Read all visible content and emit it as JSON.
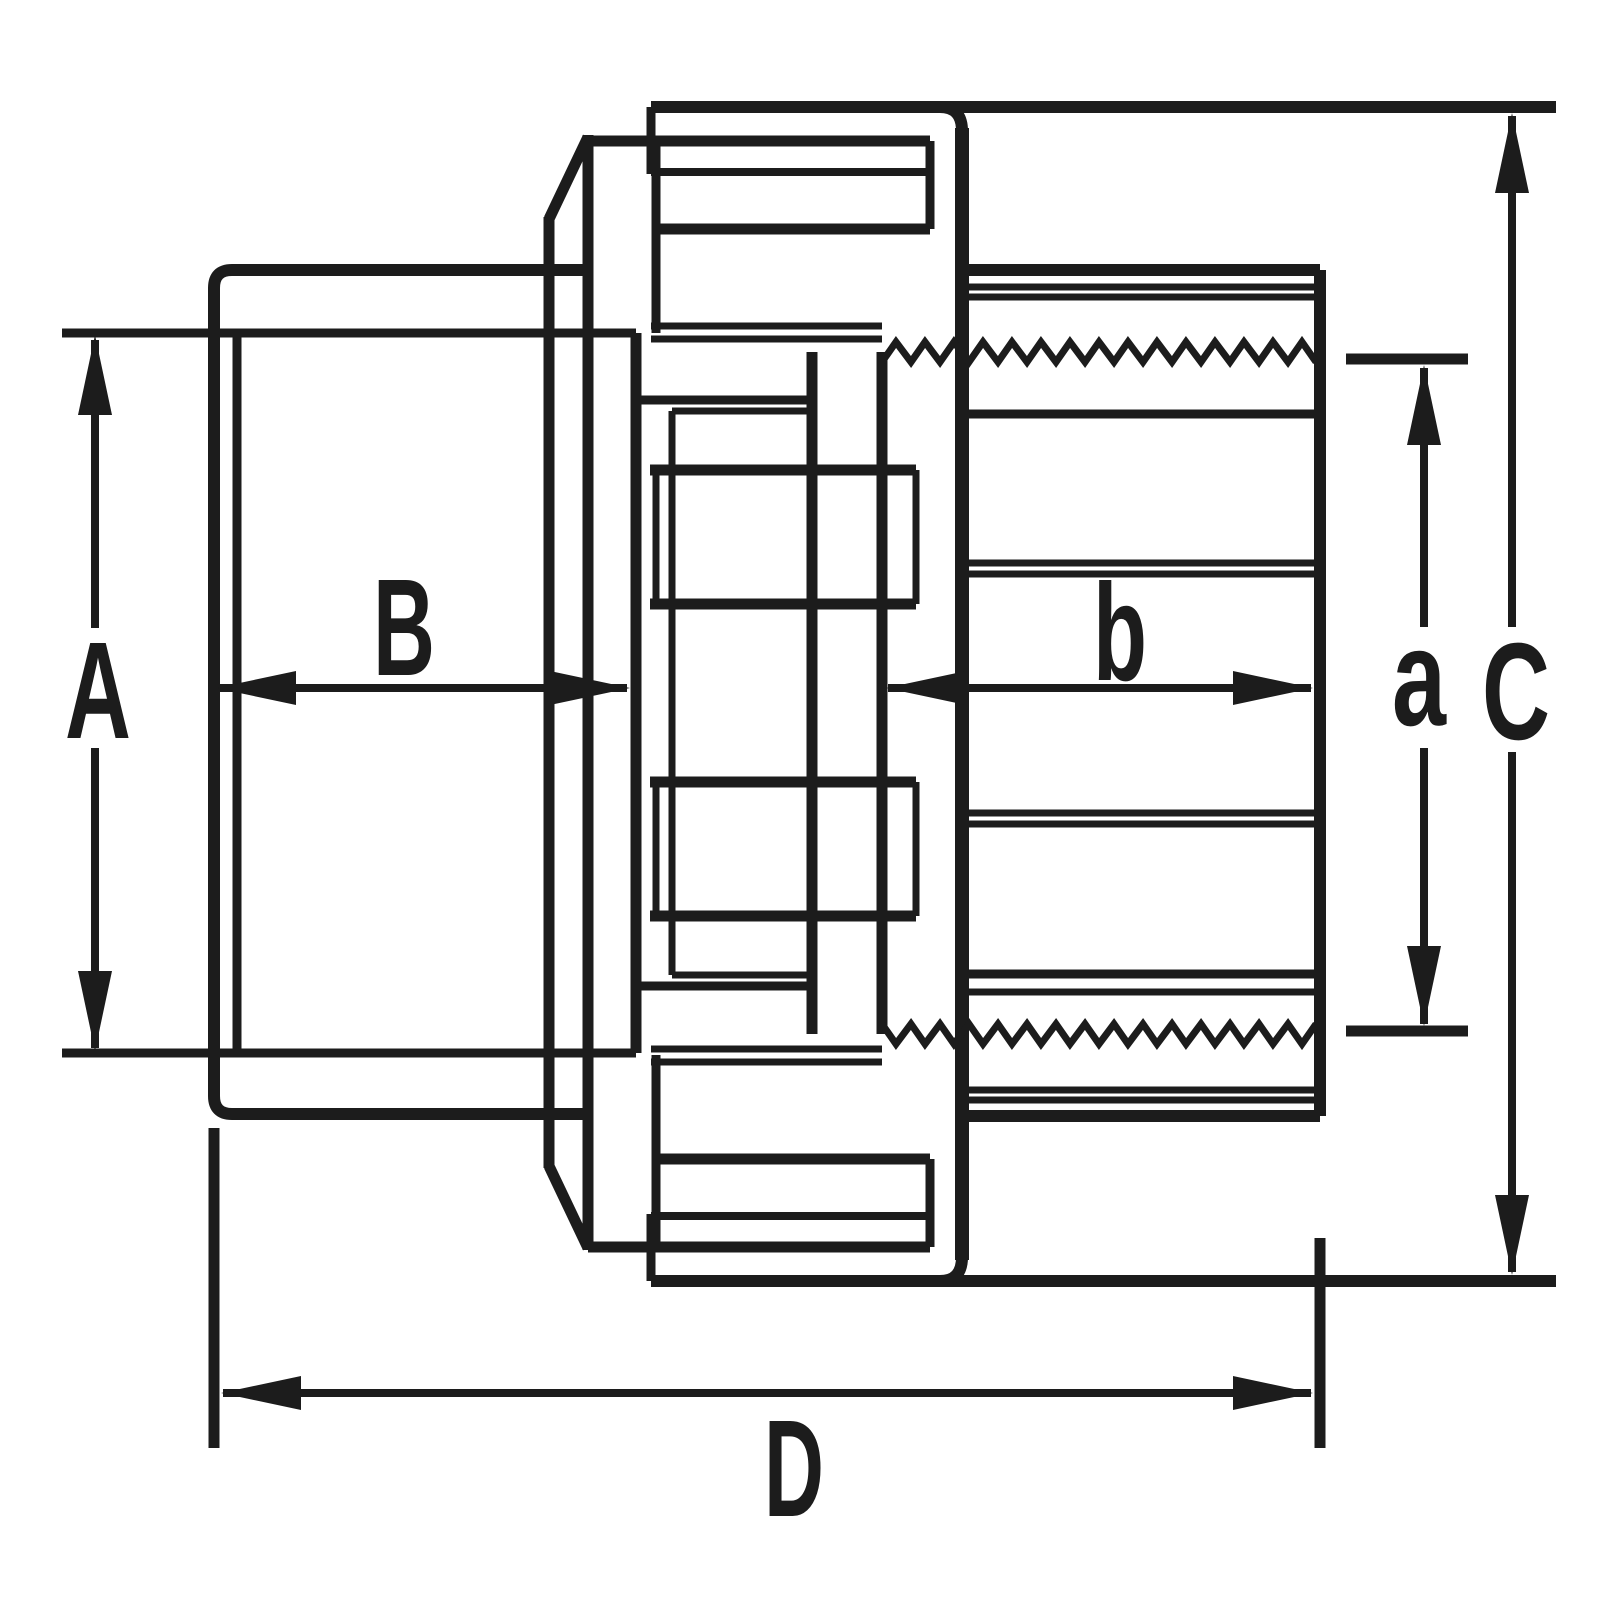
{
  "drawing": {
    "kind": "technical-dimension-diagram",
    "subject": "pipe union fitting cross-section",
    "background_color": "#ffffff",
    "line_color": "#1c1c1c",
    "dimensions": {
      "A": "A",
      "B": "B",
      "C": "C",
      "D": "D",
      "a": "a",
      "b": "b"
    }
  }
}
